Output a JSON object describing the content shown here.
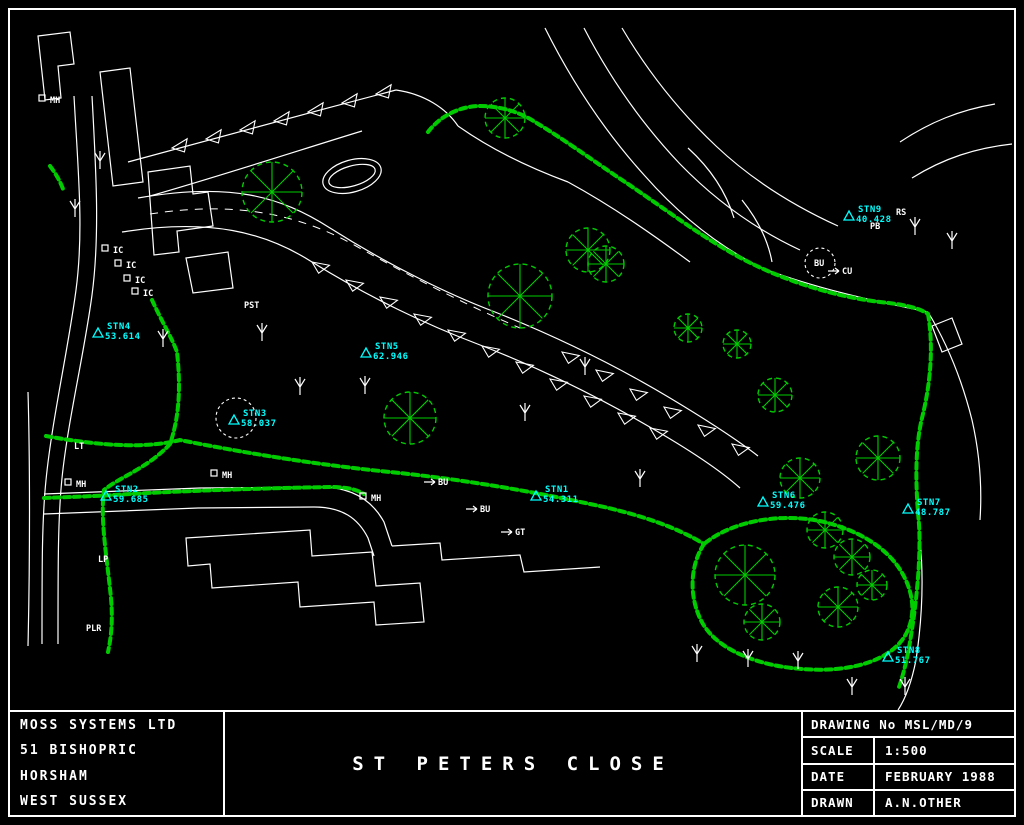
{
  "colors": {
    "background": "#000000",
    "line": "#ffffff",
    "vegetation": "#00cc00",
    "station": "#00ffff",
    "border": "#ffffff"
  },
  "title_block": {
    "company": [
      "MOSS SYSTEMS LTD",
      "51 BISHOPRIC",
      "HORSHAM",
      "WEST SUSSEX"
    ],
    "drawing_title": "ST PETERS CLOSE",
    "drawing_no": "DRAWING No MSL/MD/9",
    "rows": [
      {
        "label": "SCALE",
        "value": "1:500"
      },
      {
        "label": "DATE",
        "value": "FEBRUARY 1988"
      },
      {
        "label": "DRAWN",
        "value": "A.N.OTHER"
      }
    ]
  },
  "stations": [
    {
      "name": "STN1",
      "elevation": "54.311",
      "x": 545,
      "y": 489
    },
    {
      "name": "STN2",
      "elevation": "59.685",
      "x": 115,
      "y": 489
    },
    {
      "name": "STN3",
      "elevation": "58.037",
      "x": 243,
      "y": 413
    },
    {
      "name": "STN4",
      "elevation": "53.614",
      "x": 107,
      "y": 326
    },
    {
      "name": "STN5",
      "elevation": "62.946",
      "x": 375,
      "y": 346
    },
    {
      "name": "STN6",
      "elevation": "59.476",
      "x": 772,
      "y": 495
    },
    {
      "name": "STN7",
      "elevation": "48.787",
      "x": 917,
      "y": 502
    },
    {
      "name": "STN8",
      "elevation": "51.767",
      "x": 897,
      "y": 650
    },
    {
      "name": "STN9",
      "elevation": "40.428",
      "x": 858,
      "y": 209
    }
  ],
  "point_labels": [
    {
      "text": "IC",
      "x": 113,
      "y": 253,
      "marker": "square"
    },
    {
      "text": "IC",
      "x": 126,
      "y": 268,
      "marker": "square"
    },
    {
      "text": "IC",
      "x": 135,
      "y": 283,
      "marker": "square"
    },
    {
      "text": "IC",
      "x": 143,
      "y": 296,
      "marker": "square"
    },
    {
      "text": "MH",
      "x": 50,
      "y": 103,
      "marker": "square"
    },
    {
      "text": "MH",
      "x": 76,
      "y": 487,
      "marker": "square"
    },
    {
      "text": "MH",
      "x": 222,
      "y": 478,
      "marker": "square"
    },
    {
      "text": "MH",
      "x": 371,
      "y": 501,
      "marker": "square"
    },
    {
      "text": "BU",
      "x": 438,
      "y": 485,
      "marker": "tick"
    },
    {
      "text": "BU",
      "x": 480,
      "y": 512,
      "marker": "tick"
    },
    {
      "text": "GT",
      "x": 515,
      "y": 535,
      "marker": "tick"
    },
    {
      "text": "PST",
      "x": 244,
      "y": 308,
      "marker": "none"
    },
    {
      "text": "LT",
      "x": 74,
      "y": 449,
      "marker": "none"
    },
    {
      "text": "LP",
      "x": 98,
      "y": 562,
      "marker": "none"
    },
    {
      "text": "PLR",
      "x": 86,
      "y": 631,
      "marker": "none"
    },
    {
      "text": "BU",
      "x": 814,
      "y": 266,
      "marker": "circle"
    },
    {
      "text": "CU",
      "x": 842,
      "y": 274,
      "marker": "tick"
    },
    {
      "text": "RS",
      "x": 896,
      "y": 215,
      "marker": "none"
    },
    {
      "text": "PB",
      "x": 870,
      "y": 229,
      "marker": "none"
    }
  ]
}
